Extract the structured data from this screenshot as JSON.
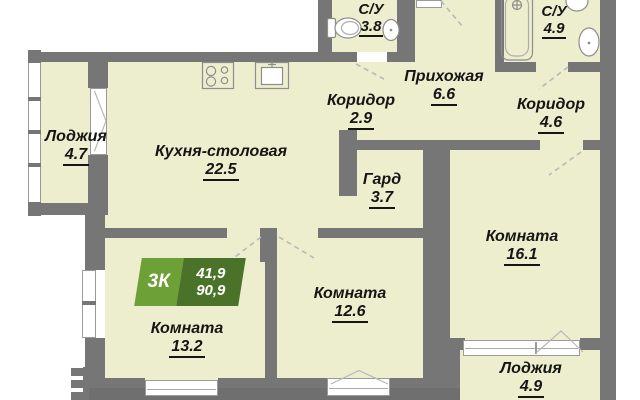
{
  "plan": {
    "badge": {
      "type_label": "3К",
      "upper_value": "41,9",
      "lower_value": "90,9"
    },
    "rooms": [
      {
        "id": "loggia-top-left",
        "name": "Лоджия",
        "area": "4.7"
      },
      {
        "id": "kitchen-dining",
        "name": "Кухня-столовая",
        "area": "22.5"
      },
      {
        "id": "corridor-left",
        "name": "Коридор",
        "area": "2.9"
      },
      {
        "id": "hallway",
        "name": "Прихожая",
        "area": "6.6"
      },
      {
        "id": "bathroom-small",
        "name": "С/У",
        "area": "3.8"
      },
      {
        "id": "bathroom-large",
        "name": "С/У",
        "area": "4.9"
      },
      {
        "id": "corridor-right",
        "name": "Коридор",
        "area": "4.6"
      },
      {
        "id": "wardrobe",
        "name": "Гард",
        "area": "3.7"
      },
      {
        "id": "room-right",
        "name": "Комната",
        "area": "16.1"
      },
      {
        "id": "room-middle",
        "name": "Комната",
        "area": "12.6"
      },
      {
        "id": "room-left",
        "name": "Комната",
        "area": "13.2"
      },
      {
        "id": "loggia-bottom-right",
        "name": "Лоджия",
        "area": "4.9"
      }
    ],
    "fixtures": {
      "kitchen": [
        "stove-icon",
        "kitchen-sink-icon"
      ],
      "bathroom_small": [
        "toilet-icon",
        "washbasin-icon"
      ],
      "bathroom_large": [
        "bathtub-icon",
        "toilet-icon",
        "washbasin-icon"
      ]
    },
    "colors": {
      "floor": "#edeecd",
      "wall": "#767676",
      "outside_fill": "#6f6f6f",
      "badge_green_light": "#6da037",
      "badge_green_dark": "#4a7228",
      "badge_text": "#ffffff",
      "label_text": "#151515"
    }
  }
}
